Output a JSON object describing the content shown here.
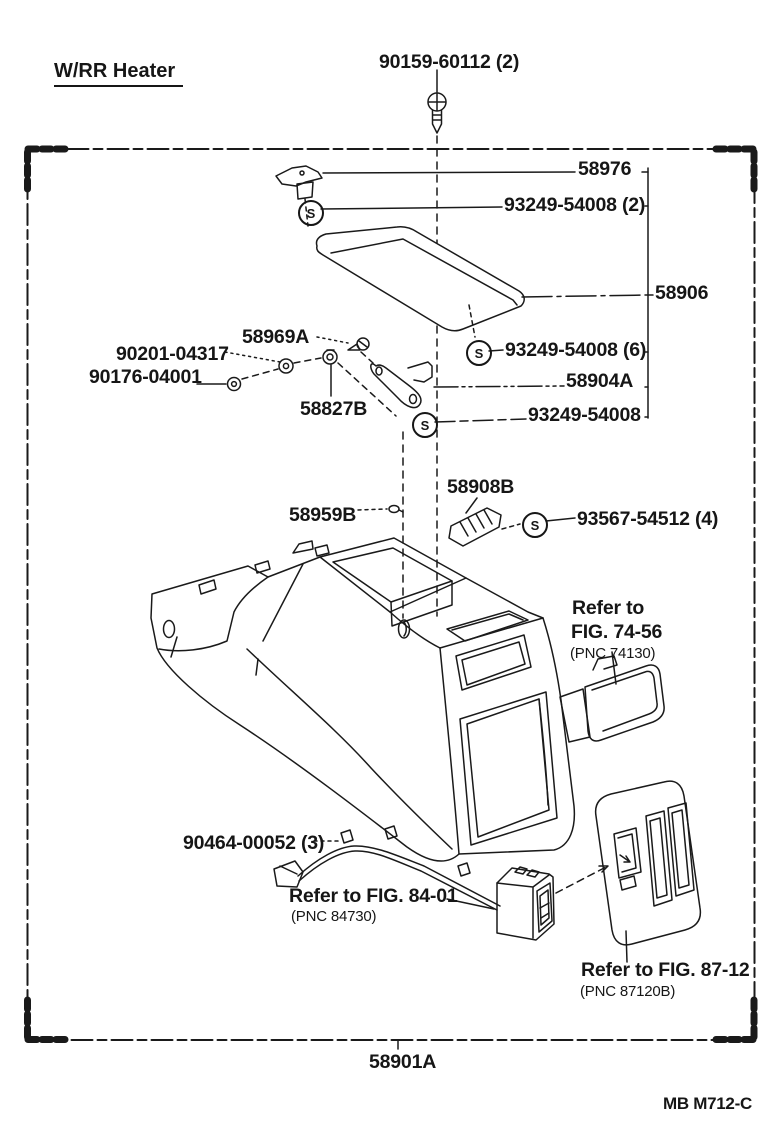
{
  "meta": {
    "variant_label": "W/RR Heater",
    "figure_code": "MB M712-C",
    "diagram_subject": "center console box exploded view"
  },
  "symbols": {
    "s": "S"
  },
  "labels": {
    "p90159": "90159-60112 (2)",
    "p58976": "58976",
    "p93249_2": "93249-54008 (2)",
    "p58906": "58906",
    "p93249_6": "93249-54008 (6)",
    "p58969a": "58969A",
    "p90201": "90201-04317",
    "p90176": "90176-04001",
    "p58827b": "58827B",
    "p58904a": "58904A",
    "p93249": "93249-54008",
    "p58908b": "58908B",
    "p58959b": "58959B",
    "p93567": "93567-54512 (4)",
    "p90464": "90464-00052 (3)",
    "p58901a": "58901A"
  },
  "references": {
    "fig7456_line1": "Refer to",
    "fig7456_line2": "FIG. 74-56",
    "fig7456_pnc": "(PNC 74130)",
    "fig8401": "Refer to FIG. 84-01",
    "fig8401_pnc": "(PNC 84730)",
    "fig8712": "Refer to FIG. 87-12",
    "fig8712_pnc": "(PNC 87120B)"
  },
  "colors": {
    "ink": "#1a1a1a",
    "paper": "#ffffff"
  }
}
